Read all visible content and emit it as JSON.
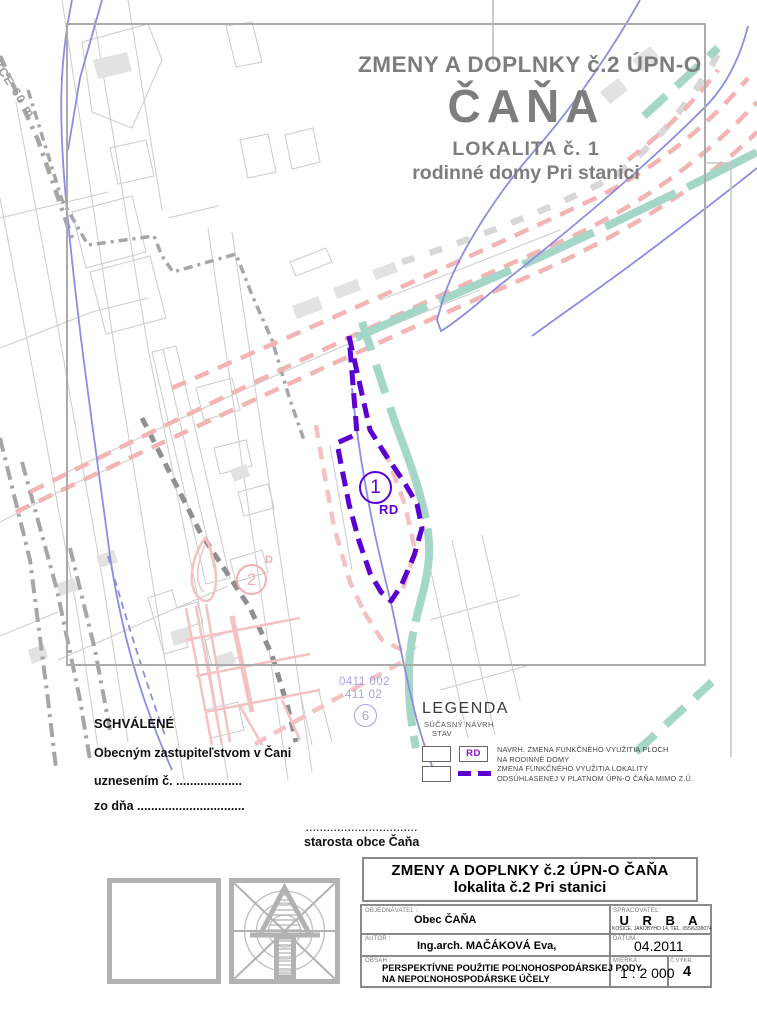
{
  "map": {
    "railway_label": "ŽELEZNICE 60 m",
    "locality_number": "1",
    "locality_use_code": "RD",
    "locality2_number": "2",
    "locality2_suffix": "D",
    "area_number": "6",
    "parcel_code_line1": "0411 002",
    "parcel_code_line2": "411 02"
  },
  "title": {
    "line1": "ZMENY A DOPLNKY č.2 ÚPN-O",
    "line2": "ČAŇA",
    "line3": "LOKALITA  č. 1",
    "line4": "rodinné domy Pri stanici"
  },
  "approval": {
    "heading": "SCHVÁLENÉ",
    "line1": "Obecným zastupiteľstvom  v Čani",
    "line2": "uznesením č.  ...................",
    "line3": "zo dňa ...............................",
    "signature_dots": "................................",
    "signature_label": "starosta obce Čaňa"
  },
  "legend": {
    "heading": "LEGENDA",
    "header_line1": "SÚČASNÝ NÁVRH",
    "header_line2": "STAV",
    "rows": [
      {
        "symbol": "RD",
        "label_line1": "NAVRH. ZMENA FUNKČNÉHO VYUŽITIA PLOCH",
        "label_line2": "NA  RODINNÉ DOMY"
      },
      {
        "symbol": "dashed-purple-line",
        "label_line1": "ZMENA FUNKČNÉHO VYUŽITIA LOKALITY",
        "label_line2": "ODSÚHLASENEJ V PLATNOM  ÚPN-O ČAŇA MIMO Z.Ú."
      }
    ]
  },
  "title_block": {
    "header_line1": "ZMENY A DOPLNKY č.2  ÚPN-O  ČAŇA",
    "header_line2": "lokalita č.2 Pri stanici",
    "client_label": "OBJEDNÁVATEĽ :",
    "client_value": "Obec ČAŇA",
    "contractor_label": "SPRACOVATEĽ:",
    "contractor_value": "U R B A",
    "contractor_address": "KOŠICE, JAKOBYHO 14, TEL. 055/6338074",
    "author_label": "AUTOR :",
    "author_value": "Ing.arch. MAČÁKOVÁ Eva,",
    "date_label": "DÁTUM :",
    "date_value": "04.2011",
    "content_label": "OBSAH :",
    "content_line1": "PERSPEKTÍVNE  POUŽITIE POĽNOHOSPODÁRSKEJ PODY",
    "content_line2": "NA NEPOĽNOHOSPODÁRSKE ÚČELY",
    "scale_label": "MIERKA :",
    "scale_value": "1 : 2 000",
    "sheet_label": "Č.VÝKR.",
    "sheet_value": "4"
  },
  "colors": {
    "boundary_purple": "#5a00d0",
    "greenbelt_teal": "#a4d7c7",
    "road_pink": "#f2b4b4",
    "stream_blue": "#8d8de0",
    "frame_gray": "#ababab",
    "title_gray": "#7d7d7d"
  }
}
